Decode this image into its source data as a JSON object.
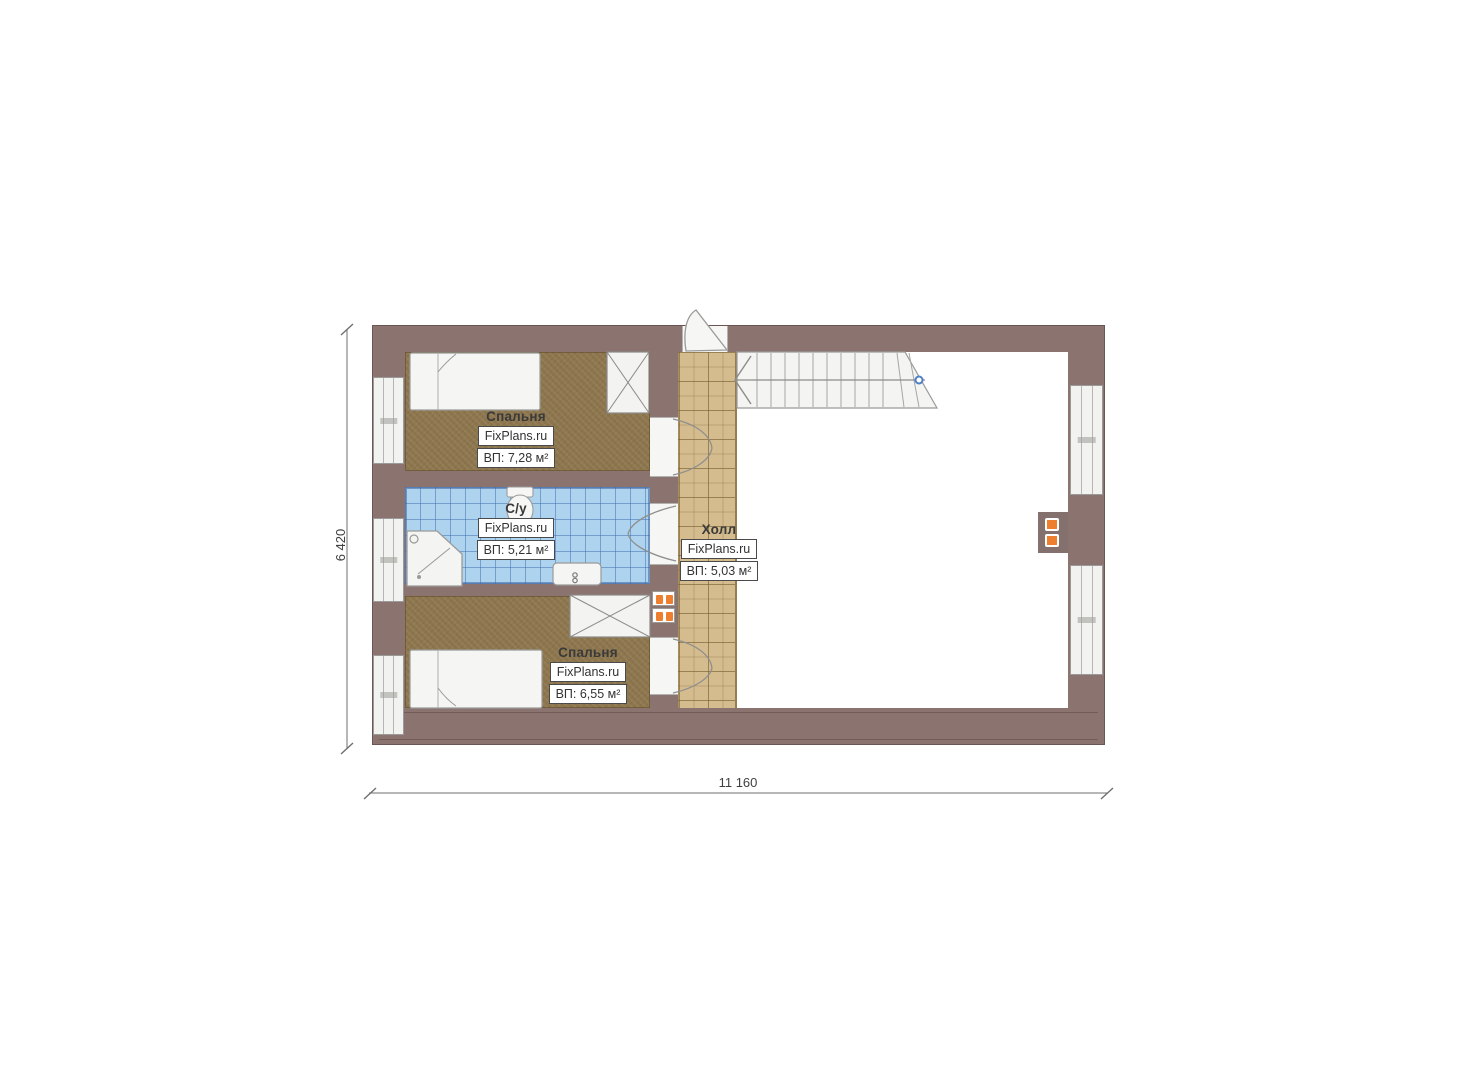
{
  "watermark": "FixPlans.ru",
  "dimensions": {
    "horizontal": "11 160",
    "vertical": "6 420"
  },
  "rooms": [
    {
      "id": "bedroom-top",
      "name": "Спальня",
      "brand": "FixPlans.ru",
      "area": "ВП: 7,28 м²"
    },
    {
      "id": "bathroom",
      "name": "С/у",
      "brand": "FixPlans.ru",
      "area": "ВП: 5,21 м²"
    },
    {
      "id": "hall",
      "name": "Холл",
      "brand": "FixPlans.ru",
      "area": "ВП: 5,03 м²"
    },
    {
      "id": "bedroom-bottom",
      "name": "Спальня",
      "brand": "FixPlans.ru",
      "area": "ВП: 6,55 м²"
    }
  ],
  "colors": {
    "wall": "#8b7470",
    "bedroom_floor": "#8d764e",
    "bathroom_tile": "#aed3ee",
    "hall_tile": "#d5bc8e",
    "radiator_accent": "#ee7f2e",
    "stair_marker": "#4f7fc4"
  }
}
